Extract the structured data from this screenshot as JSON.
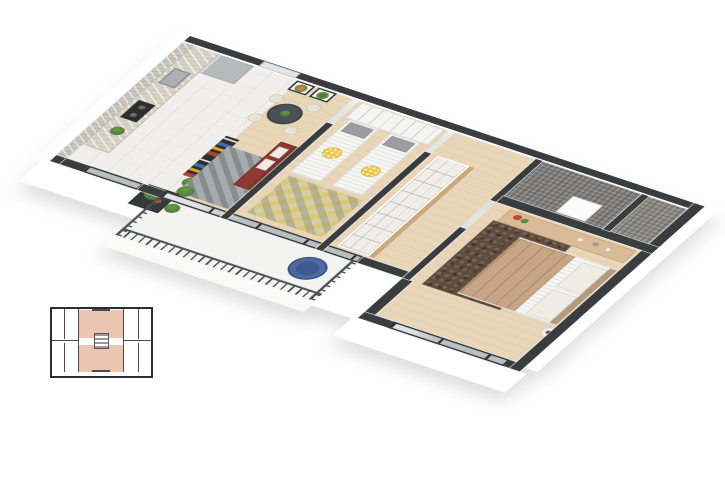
{
  "scene": {
    "type": "3d-apartment-floor-plan-render",
    "background": "#ffffff",
    "rooms": [
      "kitchen",
      "dining-area",
      "living-area",
      "kids-bedroom",
      "hallway",
      "bathroom",
      "wc",
      "master-bedroom",
      "balcony"
    ]
  },
  "colors": {
    "wall": "#393d40",
    "face": "#ffffff",
    "stone": "#c9c5bd",
    "tile": "#f0efec",
    "wood": "#e9d6b8",
    "counter": "#d8d2c6",
    "stove": "#2e2e2e",
    "sink": "#aeb1b3",
    "fridge": "#b7b9bb",
    "shelf": "#2c2e31",
    "console": "#8a5a3b",
    "table": "#4b5055",
    "chairCream": "#e7e3d8",
    "sofa": "#8c3a33",
    "sofaDark": "#7c332c",
    "pillowWhite": "#efece6",
    "rugLiving": "#a6abad",
    "wardrobe": "#f4f4f2",
    "mattress": "#f6f6f4",
    "pillowGray": "#9b9ea1",
    "cushionYellow": "#ecca4e",
    "rugKids": "#d6cfa4",
    "bathTile": "#8f8d8a",
    "bathTile2": "#99968f",
    "doorLight": "#e3e4e5",
    "doorSlab": "#fbfbfb",
    "dresser": "#d9bb97",
    "duvet": "#c7a687",
    "rugMaster": "#5f4c3c",
    "headboard": "#b59a7e",
    "balconyFloor": "#f3f3f1",
    "railing": "#4a4f53",
    "chairBlue": "#4d6ba0",
    "chairBlueDark": "#3e5a8e",
    "plant": "#4e7d3a",
    "flower": "#c04a3a",
    "glass": "#b9c0c2",
    "frameDark": "#2e3236",
    "keyWall": "#2e2e2e",
    "keyHighlight": "#ecc5b1",
    "keyStair": "#9a9a9a"
  },
  "keyplan": {
    "highlighted_units": 2,
    "highlight_color": "#ecc5b1"
  }
}
